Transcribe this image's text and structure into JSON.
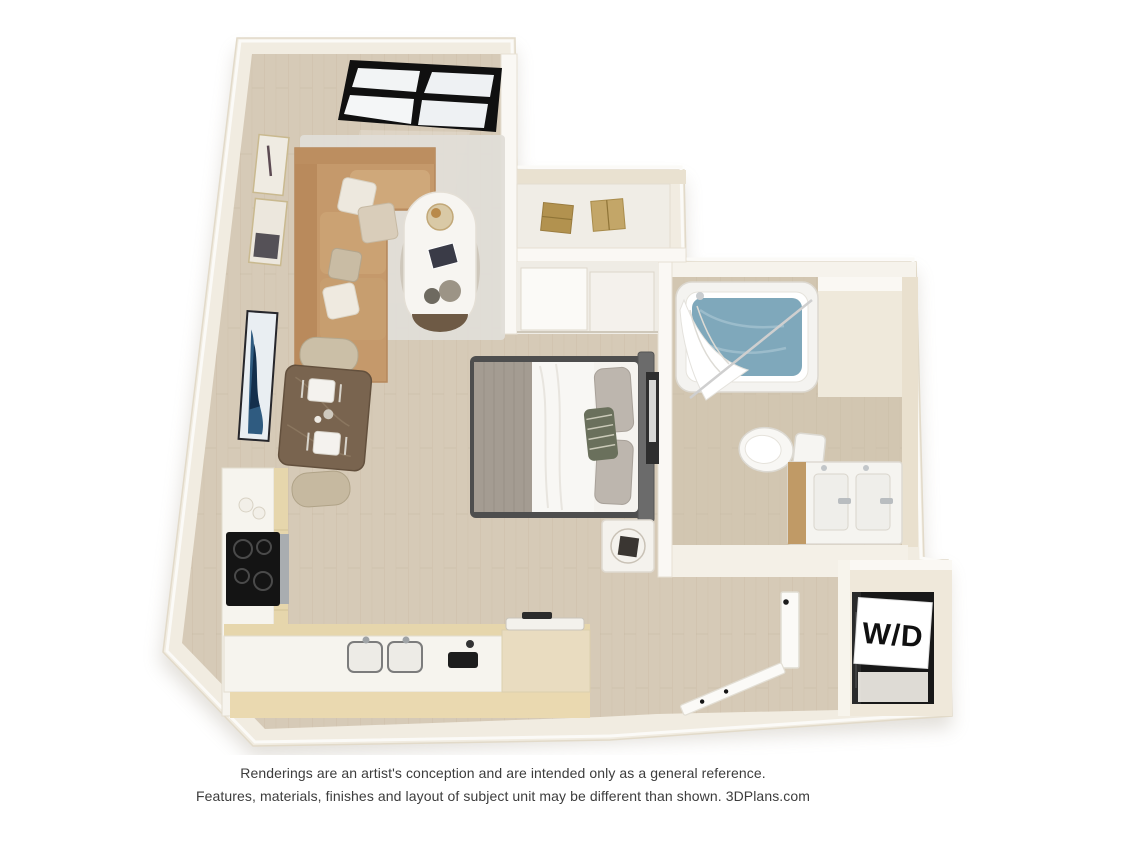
{
  "page": {
    "width": 1125,
    "height": 844,
    "background": "#ffffff"
  },
  "plan": {
    "type": "3d-floor-plan-rendering",
    "unit_style": "studio apartment",
    "labels": {
      "washer_dryer": "W/D"
    },
    "rooms": [
      {
        "name": "living-area",
        "furnishings": [
          "tan-sofa-with-pillows",
          "oval-coffee-table",
          "area-rug",
          "two-framed-artworks",
          "black-framed-window"
        ]
      },
      {
        "name": "dining-nook",
        "furnishings": [
          "marble-dining-table",
          "two-beige-chairs",
          "two-place-settings",
          "blue-abstract-wall-art"
        ]
      },
      {
        "name": "kitchen",
        "furnishings": [
          "l-shaped-counter",
          "black-cooktop",
          "stainless-oven-front",
          "double-sink",
          "wood-cabinets",
          "canisters",
          "small-appliance"
        ]
      },
      {
        "name": "sleeping-area",
        "furnishings": [
          "bed-with-gray-blanket",
          "gray-pillows",
          "accent-pillow",
          "nightstand",
          "sliding-door-closet",
          "storage-nook-with-boxes",
          "leaning-frame"
        ]
      },
      {
        "name": "bathroom",
        "furnishings": [
          "bathtub-with-water",
          "shower-curtain",
          "toilet",
          "double-vanity",
          "open-door"
        ]
      },
      {
        "name": "entry-hall",
        "furnishings": [
          "open-front-door",
          "laundry-closet"
        ]
      }
    ]
  },
  "disclaimer": {
    "line1": "Renderings are an artist's conception and are intended only as a general reference.",
    "line2": "Features, materials, finishes and layout of subject unit may be different than shown. 3DPlans.com"
  },
  "colors": {
    "wall_cream": "#efe8da",
    "wall_white": "#faf8f4",
    "floor_wood": "#d6cab7",
    "floor_bath": "#d2c6b1",
    "rug": "#e0ddd7",
    "sofa_tan": "#c5996b",
    "dining_table_brown": "#79644f",
    "chair_beige": "#cbbfa7",
    "cabinet_wood": "#e6d6ac",
    "countertop_white": "#f6f4ee",
    "cooktop_black": "#141414",
    "bed_linen": "#f5f3ef",
    "blanket_gray": "#a49c92",
    "tub_water": "#7fa8bb",
    "fixture_white": "#f6f5f2",
    "appliance_dark": "#181818",
    "window_frame": "#101010",
    "art_blue": "#2f5b80",
    "box_tan": "#c3a668",
    "text_gray": "#3c3c3c"
  }
}
